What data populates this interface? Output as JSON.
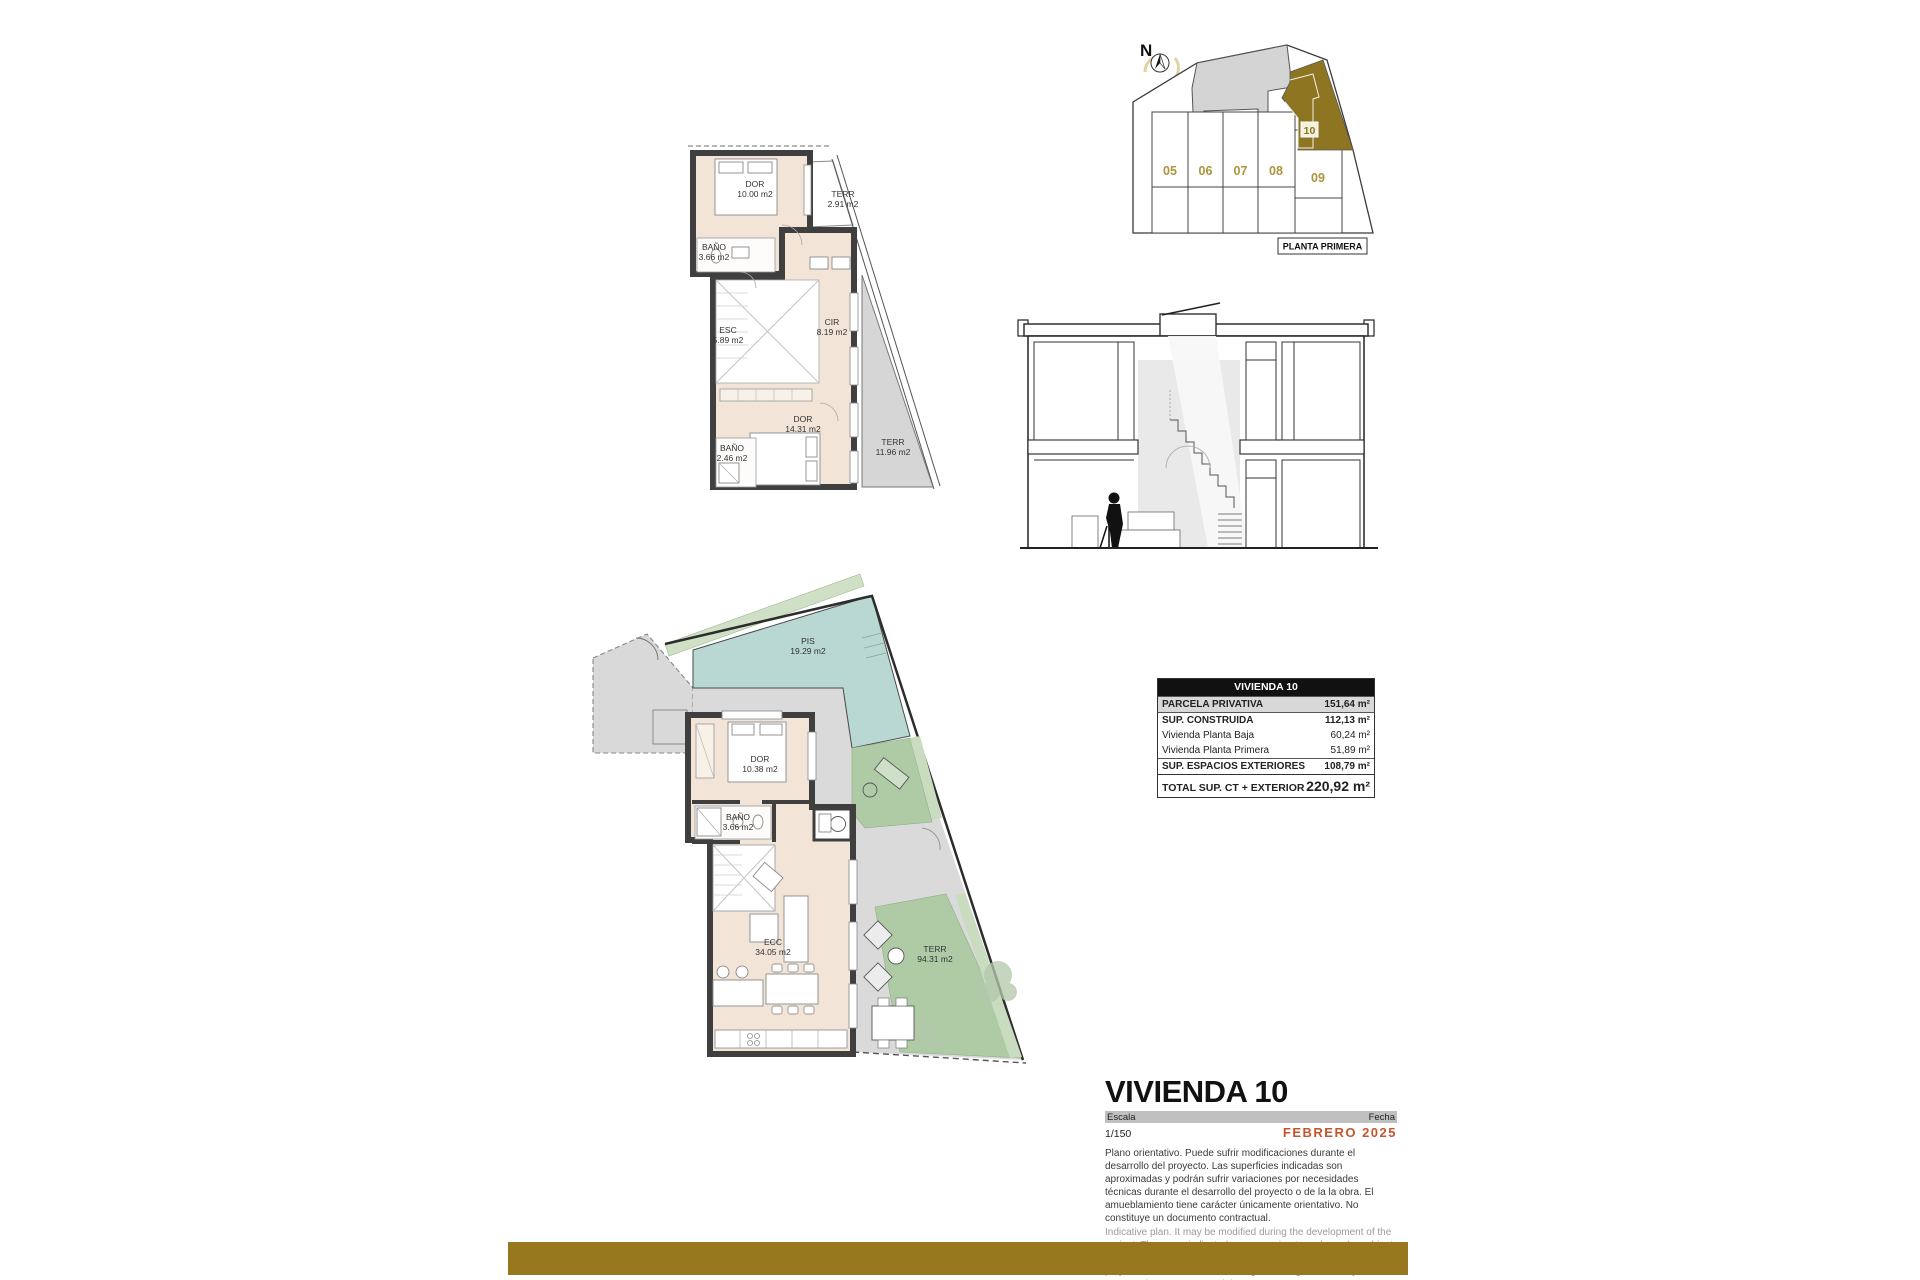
{
  "site_plan": {
    "compass": "N",
    "caption": "PLANTA PRIMERA",
    "units": [
      "05",
      "06",
      "07",
      "08",
      "09"
    ],
    "highlighted_unit": "10"
  },
  "first_floor_plan": {
    "rooms": [
      {
        "name": "DOR",
        "area": "10.00 m2"
      },
      {
        "name": "TERR",
        "area": "2.91 m2"
      },
      {
        "name": "BAÑO",
        "area": "3.66 m2"
      },
      {
        "name": "ESC",
        "area": "5.89 m2"
      },
      {
        "name": "CIR",
        "area": "8.19 m2"
      },
      {
        "name": "DOR",
        "area": "14.31 m2"
      },
      {
        "name": "BAÑO",
        "area": "2.46 m2"
      },
      {
        "name": "TERR",
        "area": "11.96 m2"
      }
    ]
  },
  "ground_floor_plan": {
    "rooms": [
      {
        "name": "PIS",
        "area": "19.29 m2"
      },
      {
        "name": "DOR",
        "area": "10.38 m2"
      },
      {
        "name": "BAÑO",
        "area": "3.66 m2"
      },
      {
        "name": "ECC",
        "area": "34.05 m2"
      },
      {
        "name": "TERR",
        "area": "94.31 m2"
      }
    ]
  },
  "surface_table": {
    "header": "VIVIENDA 10",
    "rows": [
      {
        "label": "PARCELA PRIVATIVA",
        "value": "151,64 m²"
      },
      {
        "label": "SUP. CONSTRUIDA",
        "value": "112,13 m²"
      },
      {
        "label": "Vivienda Planta Baja",
        "value": "60,24 m²"
      },
      {
        "label": "Vivienda Planta Primera",
        "value": "51,89 m²"
      },
      {
        "label": "SUP. ESPACIOS EXTERIORES",
        "value": "108,79 m²"
      },
      {
        "label": "TOTAL SUP. CT + EXTERIOR",
        "value": "220,92 m²"
      }
    ]
  },
  "title_block": {
    "title": "VIVIENDA 10",
    "scale_label": "Escala",
    "scale_value": "1/150",
    "date_label": "Fecha",
    "date_value": "FEBRERO 2025",
    "disclaimer_es": "Plano orientativo. Puede sufrir modificaciones durante el desarrollo del proyecto. Las superficies indicadas son aproximadas y podrán sufrir variaciones por necesidades técnicas durante el desarrollo del proyecto o de la la obra. El amueblamiento tiene carácter únicamente orientativo. No constituye un documento contractual.",
    "disclaimer_en": "Indicative plan. It may be modified during the development of the project. The areas indicated are approximate and may be subject to variations due to technical needs during the development of the project or the work. The furnishings are for guidance only. It does not constitute a contractual document."
  },
  "colors": {
    "accent_gold": "#97781f",
    "unit_fill_gold": "#8d7522",
    "unit_number_gold": "#ab943b",
    "date_orange": "#c2562c",
    "pool_teal": "#b9d8d3",
    "garden_green": "#aecba6",
    "room_beige": "#f2e4d6",
    "wall_dark": "#3f3f3f",
    "paving_gray": "#d9d9d9",
    "table_highlight_gray": "#d8d8d8"
  }
}
